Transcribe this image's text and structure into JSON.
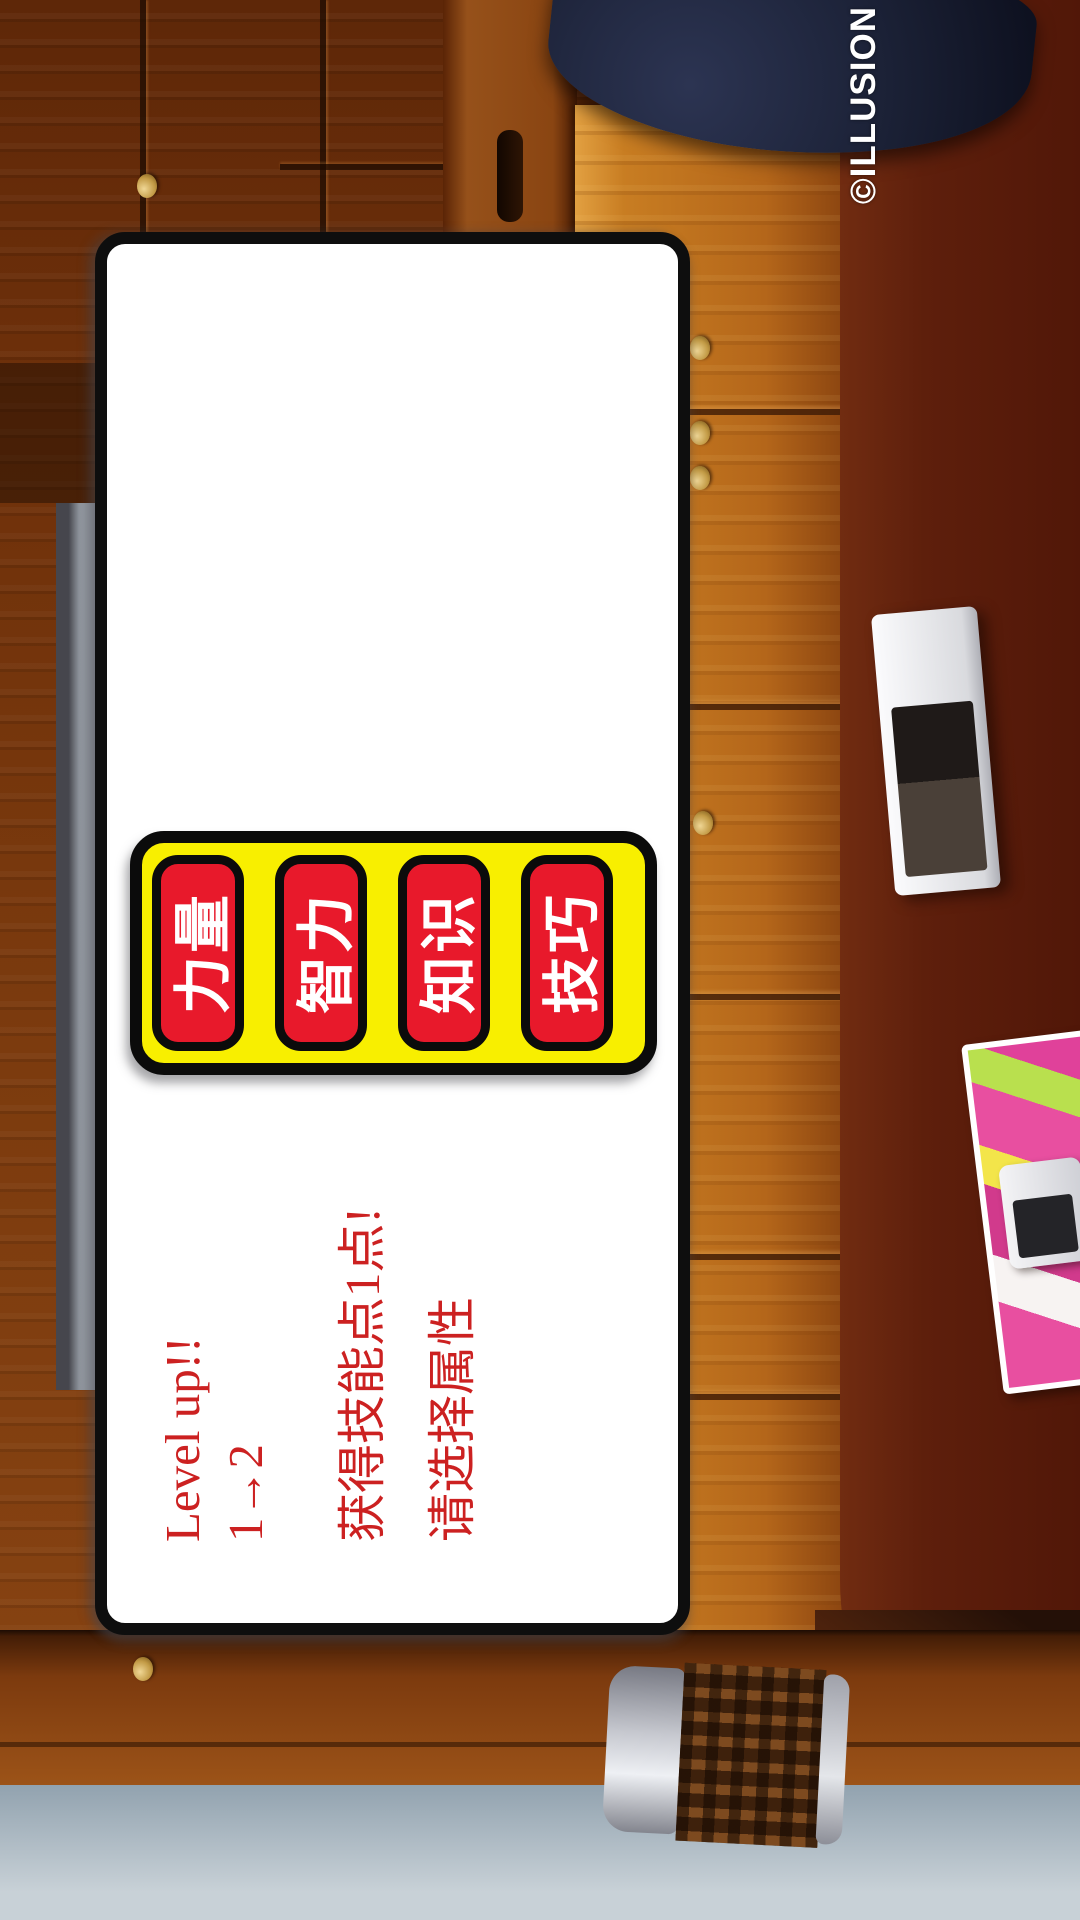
{
  "watermark": "©ILLUSION",
  "dialog": {
    "lines": [
      "Level up!!",
      "1→2",
      "获得技能点1点!",
      "请选择属性"
    ],
    "buttons": [
      {
        "id": "strength",
        "label": "力量"
      },
      {
        "id": "intelligence",
        "label": "智力"
      },
      {
        "id": "knowledge",
        "label": "知识"
      },
      {
        "id": "skill",
        "label": "技巧"
      }
    ]
  },
  "colors": {
    "dialog_bg": "#ffffff",
    "dialog_border": "#0e0e0e",
    "panel_bg": "#f8ef00",
    "button_bg": "#e8192b",
    "button_text": "#ffffff",
    "message_text": "#cc2121",
    "watermark_text": "#ffffff"
  }
}
